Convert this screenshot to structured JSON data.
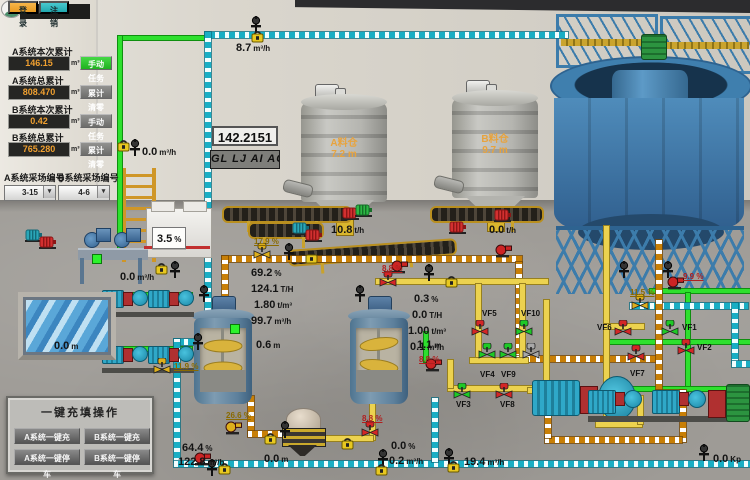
{
  "auth": {
    "login": "登 录",
    "logout": "注 销"
  },
  "totals": {
    "unit": "m³",
    "rows": [
      {
        "label": "A系统本次累计",
        "value": "146.15",
        "button": "手动任务"
      },
      {
        "label": "A系统总累计",
        "value": "808.470",
        "button": "累计清零"
      },
      {
        "label": "B系统本次累计",
        "value": "0.42",
        "button": "手动任务"
      },
      {
        "label": "B系统总累计",
        "value": "765.280",
        "button": "累计清零"
      }
    ]
  },
  "site_select": {
    "a_label": "A系统采场编号",
    "a_value": "3-15",
    "b_label": "B系统采场编号",
    "b_value": "4-6"
  },
  "display_box": {
    "value": "142.2151",
    "ticker": "GL LJ AI ACC"
  },
  "quick_ops": {
    "title": "一键充填操作",
    "buttons": [
      "A系统一键充填",
      "B系统一键充填",
      "A系统一键停车",
      "B系统一键停车"
    ]
  },
  "silos": {
    "a_name": "A料仓",
    "a_level": "7.2",
    "b_name": "B料仓",
    "b_level": "9.7",
    "level_unit": "m"
  },
  "scene": {
    "readings": [
      {
        "v": "8.7",
        "u": "m³/h",
        "x": 236,
        "y": 38
      },
      {
        "v": "0.0",
        "u": "m³/h",
        "x": 142,
        "y": 142
      },
      {
        "v": "0.0",
        "u": "m³/h",
        "x": 120,
        "y": 267
      },
      {
        "v": "3.5",
        "u": "%",
        "x": 152,
        "y": 227,
        "cls": "boxed"
      },
      {
        "v": "10.8",
        "u": "t/h",
        "x": 331,
        "y": 220
      },
      {
        "v": "0.0",
        "u": "t/h",
        "x": 489,
        "y": 220
      },
      {
        "v": "69.2",
        "u": "%",
        "x": 251,
        "y": 263
      },
      {
        "v": "124.1",
        "u": "T/H",
        "x": 251,
        "y": 279
      },
      {
        "v": "1.80",
        "u": "t/m³",
        "x": 254,
        "y": 295
      },
      {
        "v": "99.7",
        "u": "m³/h",
        "x": 251,
        "y": 311
      },
      {
        "v": "0.3",
        "u": "%",
        "x": 414,
        "y": 289
      },
      {
        "v": "0.0",
        "u": "T/H",
        "x": 412,
        "y": 305
      },
      {
        "v": "1.00",
        "u": "t/m³",
        "x": 408,
        "y": 321
      },
      {
        "v": "0.1",
        "u": "m³/h",
        "x": 410,
        "y": 337
      },
      {
        "v": "0.6",
        "u": "m",
        "x": 256,
        "y": 335
      },
      {
        "v": "1.1",
        "u": "m",
        "x": 417,
        "y": 335
      },
      {
        "v": "0.0",
        "u": "m",
        "x": 54,
        "y": 336
      },
      {
        "v": "64.4",
        "u": "%",
        "x": 182,
        "y": 438
      },
      {
        "v": "122.8",
        "u": "m³/h",
        "x": 178,
        "y": 452
      },
      {
        "v": "0.0",
        "u": "%",
        "x": 391,
        "y": 436
      },
      {
        "v": "0.2",
        "u": "m³/h",
        "x": 389,
        "y": 451
      },
      {
        "v": "0.0",
        "u": "m",
        "x": 264,
        "y": 449
      },
      {
        "v": "19.4",
        "u": "m³/h",
        "x": 464,
        "y": 452
      },
      {
        "v": "0.0",
        "u": "Kp",
        "x": 713,
        "y": 449
      }
    ],
    "percents": [
      {
        "v": "17.9 %",
        "x": 254,
        "y": 237
      },
      {
        "v": "8.8 %",
        "x": 382,
        "y": 264,
        "r": 1
      },
      {
        "v": "8.8 %",
        "x": 419,
        "y": 355,
        "r": 1
      },
      {
        "v": "8.8 %",
        "x": 362,
        "y": 414,
        "r": 1
      },
      {
        "v": "9.9 %",
        "x": 683,
        "y": 272,
        "r": 1
      },
      {
        "v": "11.5 %",
        "x": 630,
        "y": 288
      },
      {
        "v": "11.9 %",
        "x": 174,
        "y": 362
      },
      {
        "v": "26.6 %",
        "x": 226,
        "y": 411
      }
    ],
    "valves": [
      {
        "tag": "VF5",
        "c": "red",
        "x": 470,
        "y": 320,
        "lx": 482,
        "ly": 309
      },
      {
        "tag": "VF10",
        "c": "green",
        "x": 514,
        "y": 320,
        "lx": 521,
        "ly": 309
      },
      {
        "tag": "VF4",
        "c": "green",
        "x": 477,
        "y": 343,
        "lx": 480,
        "ly": 370
      },
      {
        "tag": "VF9",
        "c": "green",
        "x": 498,
        "y": 343,
        "lx": 501,
        "ly": 370
      },
      {
        "c": "gray",
        "x": 521,
        "y": 343
      },
      {
        "tag": "VF3",
        "c": "green",
        "x": 452,
        "y": 383,
        "lx": 456,
        "ly": 400
      },
      {
        "tag": "VF8",
        "c": "red",
        "x": 494,
        "y": 383,
        "lx": 500,
        "ly": 400
      },
      {
        "tag": "VF6",
        "c": "red",
        "x": 613,
        "y": 320,
        "lx": 597,
        "ly": 323
      },
      {
        "tag": "VF1",
        "c": "green",
        "x": 660,
        "y": 320,
        "lx": 682,
        "ly": 323
      },
      {
        "tag": "VF2",
        "c": "red",
        "x": 676,
        "y": 339,
        "lx": 697,
        "ly": 343
      },
      {
        "tag": "VF7",
        "c": "red",
        "x": 626,
        "y": 345,
        "lx": 630,
        "ly": 369
      },
      {
        "c": "yellow",
        "x": 252,
        "y": 243
      },
      {
        "c": "red",
        "x": 378,
        "y": 271
      },
      {
        "c": "yellow",
        "x": 152,
        "y": 358
      },
      {
        "c": "yellow",
        "x": 630,
        "y": 294
      },
      {
        "c": "red",
        "x": 360,
        "y": 421
      }
    ],
    "devices": [
      {
        "t": "s",
        "x": 250,
        "y": 16
      },
      {
        "t": "f",
        "x": 251,
        "y": 29
      },
      {
        "t": "f",
        "x": 117,
        "y": 138
      },
      {
        "t": "s",
        "x": 129,
        "y": 139
      },
      {
        "t": "f",
        "x": 155,
        "y": 261
      },
      {
        "t": "s",
        "x": 169,
        "y": 261
      },
      {
        "t": "s",
        "x": 283,
        "y": 243
      },
      {
        "t": "f",
        "x": 305,
        "y": 250
      },
      {
        "t": "s",
        "x": 423,
        "y": 264
      },
      {
        "t": "f",
        "x": 445,
        "y": 274
      },
      {
        "t": "s",
        "x": 192,
        "y": 333
      },
      {
        "t": "s",
        "x": 279,
        "y": 421
      },
      {
        "t": "s",
        "x": 618,
        "y": 261
      },
      {
        "t": "s",
        "x": 662,
        "y": 261
      },
      {
        "t": "s",
        "x": 377,
        "y": 449
      },
      {
        "t": "f",
        "x": 375,
        "y": 462
      },
      {
        "t": "s",
        "x": 443,
        "y": 448
      },
      {
        "t": "f",
        "x": 447,
        "y": 459
      },
      {
        "t": "s",
        "x": 698,
        "y": 444
      },
      {
        "t": "s",
        "x": 198,
        "y": 285
      },
      {
        "t": "s",
        "x": 354,
        "y": 285
      },
      {
        "t": "f",
        "x": 341,
        "y": 436
      },
      {
        "t": "f",
        "x": 264,
        "y": 431
      },
      {
        "t": "f",
        "x": 218,
        "y": 461
      },
      {
        "t": "s",
        "x": 206,
        "y": 459
      },
      {
        "t": "p",
        "c": "red",
        "x": 390,
        "y": 260
      },
      {
        "t": "p",
        "c": "red",
        "x": 424,
        "y": 358
      },
      {
        "t": "p",
        "c": "red",
        "x": 666,
        "y": 276
      },
      {
        "t": "p",
        "c": "red",
        "x": 193,
        "y": 452
      },
      {
        "t": "p",
        "c": "red",
        "x": 494,
        "y": 244
      },
      {
        "t": "p",
        "c": "yellow",
        "x": 224,
        "y": 421
      },
      {
        "t": "m",
        "c": "red",
        "x": 342,
        "y": 207
      },
      {
        "t": "m",
        "c": "green",
        "x": 355,
        "y": 204
      },
      {
        "t": "m",
        "c": "red",
        "x": 494,
        "y": 209
      },
      {
        "t": "m",
        "c": "red",
        "x": 449,
        "y": 221
      },
      {
        "t": "m",
        "c": "teal",
        "x": 292,
        "y": 222
      },
      {
        "t": "m",
        "c": "red",
        "x": 305,
        "y": 229
      },
      {
        "t": "m",
        "c": "teal",
        "x": 25,
        "y": 229
      },
      {
        "t": "m",
        "c": "red",
        "x": 39,
        "y": 236
      },
      {
        "t": "d",
        "x": 92,
        "y": 254
      },
      {
        "t": "d",
        "x": 230,
        "y": 324
      }
    ],
    "pipes": [
      {
        "c": "green",
        "d": "h",
        "x": 118,
        "y": 36,
        "l": 90
      },
      {
        "c": "green",
        "d": "v",
        "x": 118,
        "y": 36,
        "l": 222
      },
      {
        "c": "green",
        "d": "h",
        "x": 100,
        "y": 293,
        "l": 92
      },
      {
        "c": "green",
        "d": "h",
        "x": 100,
        "y": 347,
        "l": 92
      },
      {
        "c": "green",
        "d": "v",
        "x": 424,
        "y": 332,
        "l": 30
      },
      {
        "c": "green",
        "d": "h",
        "x": 650,
        "y": 289,
        "l": 100
      },
      {
        "c": "green",
        "d": "v",
        "x": 686,
        "y": 293,
        "l": 96
      },
      {
        "c": "green",
        "d": "h",
        "x": 604,
        "y": 340,
        "l": 146
      },
      {
        "c": "green",
        "d": "h",
        "x": 604,
        "y": 387,
        "l": 146
      },
      {
        "c": "cyan",
        "d": "h",
        "x": 205,
        "y": 32,
        "l": 363
      },
      {
        "c": "cyan",
        "d": "v",
        "x": 205,
        "y": 32,
        "l": 310
      },
      {
        "c": "cyan",
        "d": "h",
        "x": 174,
        "y": 339,
        "l": 31
      },
      {
        "c": "cyan",
        "d": "v",
        "x": 174,
        "y": 339,
        "l": 123
      },
      {
        "c": "cyan",
        "d": "h",
        "x": 174,
        "y": 461,
        "l": 576
      },
      {
        "c": "cyan",
        "d": "v",
        "x": 432,
        "y": 398,
        "l": 64
      },
      {
        "c": "cyan",
        "d": "h",
        "x": 630,
        "y": 303,
        "l": 118
      },
      {
        "c": "cyan",
        "d": "v",
        "x": 732,
        "y": 303,
        "l": 60
      },
      {
        "c": "cyan",
        "d": "h",
        "x": 732,
        "y": 361,
        "l": 18
      },
      {
        "c": "orange",
        "d": "h",
        "x": 222,
        "y": 256,
        "l": 300
      },
      {
        "c": "orange",
        "d": "v",
        "x": 222,
        "y": 256,
        "l": 58
      },
      {
        "c": "orange",
        "d": "v",
        "x": 248,
        "y": 396,
        "l": 40
      },
      {
        "c": "orange",
        "d": "h",
        "x": 248,
        "y": 431,
        "l": 58
      },
      {
        "c": "orange",
        "d": "v",
        "x": 516,
        "y": 262,
        "l": 96
      },
      {
        "c": "orange",
        "d": "h",
        "x": 516,
        "y": 356,
        "l": 142
      },
      {
        "c": "orange",
        "d": "v",
        "x": 656,
        "y": 240,
        "l": 154
      },
      {
        "c": "orange",
        "d": "h",
        "x": 656,
        "y": 390,
        "l": 28
      },
      {
        "c": "orange",
        "d": "v",
        "x": 680,
        "y": 390,
        "l": 52
      },
      {
        "c": "orange",
        "d": "h",
        "x": 545,
        "y": 437,
        "l": 137
      },
      {
        "c": "orange",
        "d": "v",
        "x": 545,
        "y": 410,
        "l": 28
      },
      {
        "c": "yellow",
        "d": "h",
        "x": 376,
        "y": 279,
        "l": 172
      },
      {
        "c": "yellow",
        "d": "v",
        "x": 476,
        "y": 284,
        "l": 78
      },
      {
        "c": "yellow",
        "d": "v",
        "x": 520,
        "y": 284,
        "l": 78
      },
      {
        "c": "yellow",
        "d": "h",
        "x": 470,
        "y": 358,
        "l": 58
      },
      {
        "c": "yellow",
        "d": "h",
        "x": 448,
        "y": 386,
        "l": 86
      },
      {
        "c": "yellow",
        "d": "v",
        "x": 448,
        "y": 360,
        "l": 28
      },
      {
        "c": "yellow",
        "d": "v",
        "x": 370,
        "y": 398,
        "l": 42
      },
      {
        "c": "yellow",
        "d": "h",
        "x": 303,
        "y": 436,
        "l": 70
      },
      {
        "c": "yellow",
        "d": "v",
        "x": 604,
        "y": 226,
        "l": 200
      },
      {
        "c": "yellow",
        "d": "h",
        "x": 604,
        "y": 324,
        "l": 40
      },
      {
        "c": "yellow",
        "d": "h",
        "x": 596,
        "y": 422,
        "l": 46
      },
      {
        "c": "yellow",
        "d": "v",
        "x": 638,
        "y": 396,
        "l": 28
      },
      {
        "c": "yellow",
        "d": "v",
        "x": 544,
        "y": 300,
        "l": 112
      },
      {
        "c": "yellow",
        "d": "h",
        "x": 528,
        "y": 388,
        "l": 18
      }
    ]
  }
}
